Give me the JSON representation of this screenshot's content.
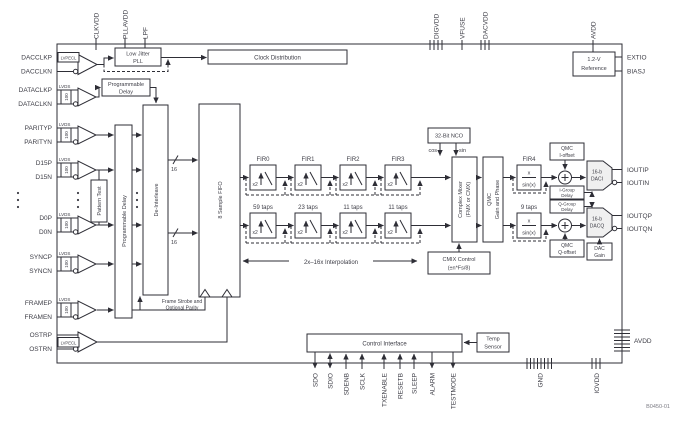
{
  "title_code": "B0450-01",
  "pins": {
    "top": [
      "CLKVDD",
      "PLLAVDD",
      "LPF",
      "DIGVDD",
      "VFUSE",
      "DACVDD",
      "AVDD"
    ],
    "left": [
      "DACCLKP",
      "DACCLKN",
      "DATACLKP",
      "DATACLKN",
      "PARITYP",
      "PARITYN",
      "D15P",
      "D15N",
      "D0P",
      "D0N",
      "SYNCP",
      "SYNCN",
      "FRAMEP",
      "FRAMEN",
      "OSTRP",
      "OSTRN"
    ],
    "right": [
      "EXTIO",
      "BIASJ",
      "IOUTIP",
      "IOUTIN",
      "IOUTQP",
      "IOUTQN",
      "AVDD"
    ],
    "bottom": [
      "SDO",
      "SDIO",
      "SDENB",
      "SCLK",
      "TXENABLE",
      "RESETB",
      "SLEEP",
      "ALARM",
      "TESTMODE",
      "GND",
      "IOVDD"
    ]
  },
  "buffers": {
    "lvds": "LVDS",
    "lvpecl": "LVPECL",
    "termination": "100"
  },
  "blocks": {
    "pll": [
      "Low Jitter",
      "PLL"
    ],
    "clock_distribution": [
      "Clock Distribution"
    ],
    "prog_delay": [
      "Programmable",
      "Delay"
    ],
    "prog_delay_vertical": [
      "Programmable Delay"
    ],
    "pattern_test": [
      "Pattern Test"
    ],
    "deinterleave": [
      "De-Interleave"
    ],
    "fifo": [
      "8 Sample FIFO"
    ],
    "frame_strobe": [
      "Frame Strobe and",
      "Optional Parity"
    ],
    "nco": [
      "32-Bit NCO"
    ],
    "nco_outputs": [
      "cos",
      "sin"
    ],
    "mixer": [
      "Complex Mixer",
      "(FMX or CMX)"
    ],
    "qmc": [
      "QMC",
      "Gain and Phase"
    ],
    "cmix": [
      "CMIX Control",
      "(±n*Fs/8)"
    ],
    "sinc": [
      "x",
      "sin(x)"
    ],
    "fir4_label": [
      "FIR4"
    ],
    "fir4_taps": [
      "9 taps"
    ],
    "qmc_i_offset": [
      "QMC",
      "I-offset"
    ],
    "qmc_q_offset": [
      "QMC",
      "Q-offset"
    ],
    "i_group": [
      "I-Group",
      "Delay"
    ],
    "q_group": [
      "Q-Group",
      "Delay"
    ],
    "dac_gain": [
      "DAC",
      "Gain"
    ],
    "daci": [
      "16-b",
      "DACI"
    ],
    "dacq": [
      "16-b",
      "DACQ"
    ],
    "reference": [
      "1.2-V",
      "Reference"
    ],
    "control_interface": [
      "Control Interface"
    ],
    "temp_sensor": [
      "Temp",
      "Sensor"
    ]
  },
  "fir": {
    "labels": [
      "FIR0",
      "FIR1",
      "FIR2",
      "FIR3"
    ],
    "taps": [
      "59 taps",
      "23 taps",
      "11 taps",
      "11 taps"
    ],
    "x2": "x2"
  },
  "annotations": {
    "interpolation": "2x–16x Interpolation",
    "bus_width": "16"
  },
  "colors": {
    "line": "#2e2e36",
    "text": "#3d3d46",
    "background": "#ffffff"
  }
}
